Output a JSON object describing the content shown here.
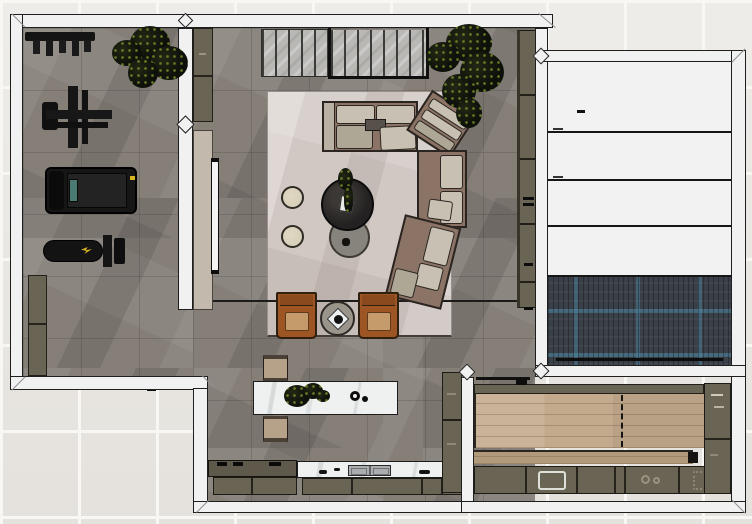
{
  "scene": {
    "type": "floor-plan-top-view-render",
    "description": "Top-down 3D rendered floor plan of a residence with home gym, living room, kitchen, garage bay and workshop"
  },
  "colors": {
    "bg_tile": "#e9e6e1",
    "bg_grout": "#f8f7f4",
    "wall": "#f0f1f0",
    "wall_edge": "#1e1e1e",
    "floor": "#857f78",
    "floor_line": "#5f5a54",
    "olive": "#6a6454",
    "olive_dark": "#4d483b",
    "tan_panel": "#c3b9ac",
    "rug": "#d1c8c3",
    "sofa_brown": "#8b7365",
    "cushion": "#c8c1b3",
    "cushion_mid": "#aea795",
    "black_table": "#242122",
    "gray_table": "#87837d",
    "pouf": "#d8cfba",
    "cognac": "#9c5523",
    "chair_seat": "#c59b6c",
    "marble": "#eff1f0",
    "bench": "#b5a289",
    "wood": "#c3aa8d",
    "wood2": "#b1997b",
    "blue_base": "#3a4048",
    "blue_accent": "#4d87a4",
    "slat": "#b9b8b5",
    "tv": "#f4f4f4",
    "steel": "#a9adb0",
    "teal": "#4b7a72",
    "gymyellow": "#d8b324"
  },
  "rooms": [
    {
      "name": "home-gym",
      "floor": "gray-tile",
      "furniture": [
        "barbell-rack",
        "cable-machine",
        "treadmill",
        "weight-bench",
        "storage-cabinets",
        "plant"
      ]
    },
    {
      "name": "living-room",
      "floor": "gray-tile",
      "furniture": [
        "area-rug",
        "sectional-sofa",
        "chaise-lounge-chair",
        "round-coffee-table-black",
        "round-coffee-table-gray",
        "pouf",
        "pouf",
        "armchair",
        "armchair",
        "side-table",
        "wall-tv",
        "media-panel",
        "slatted-closet-panels",
        "tall-cabinet-column",
        "plant"
      ]
    },
    {
      "name": "kitchen",
      "floor": "gray-tile",
      "furniture": [
        "marble-island",
        "bench",
        "bench",
        "cooktop-counter",
        "sink-counter",
        "base-cabinets",
        "tall-cabinet",
        "flower-decor"
      ]
    },
    {
      "name": "garage-bay",
      "floor": "blue-herringbone",
      "furniture": [
        "sectional-garage-door"
      ]
    },
    {
      "name": "workshop",
      "floor": "oak-plank",
      "furniture": [
        "workbench-counter",
        "base-cabinets",
        "side-cabinet-column"
      ]
    }
  ]
}
